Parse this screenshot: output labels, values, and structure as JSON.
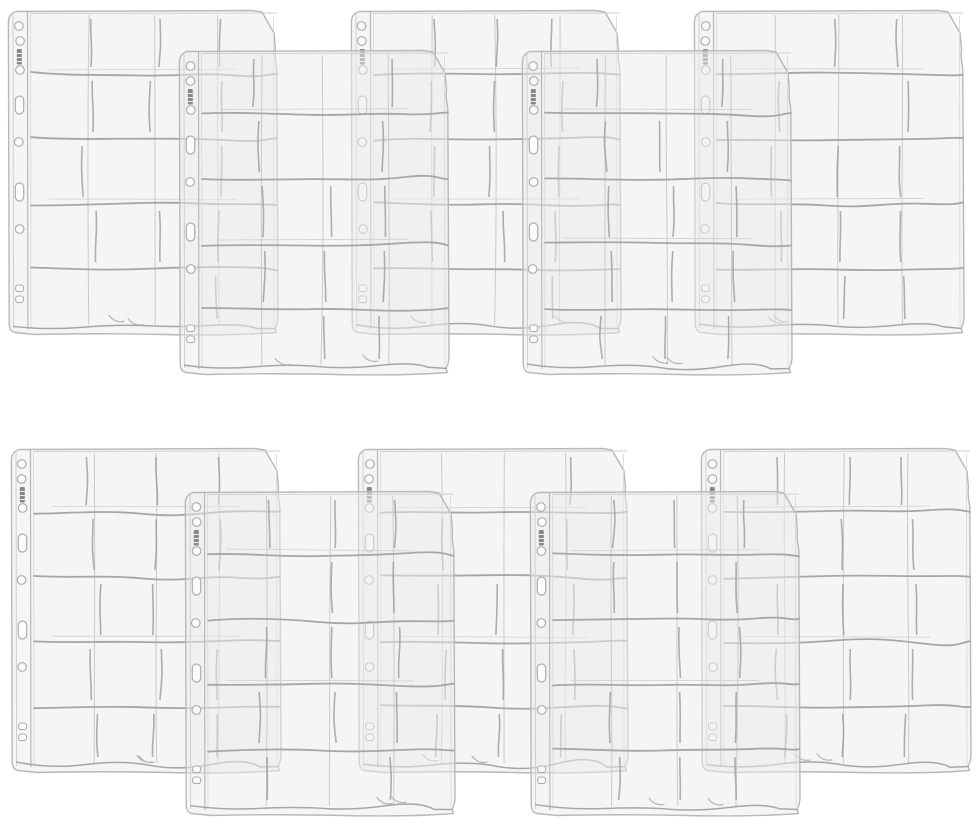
{
  "canvas": {
    "width": 980,
    "height": 828,
    "background": "#ffffff",
    "description": "Product photo: ten transparent plastic 20-pocket binder storage pages fanned out in two overlapping rows of five"
  },
  "product": {
    "item": "clear plastic pocket binder pages",
    "sheet_count": 10,
    "pockets_per_sheet": 20,
    "pocket_columns": 4,
    "pocket_rows": 5,
    "binder_edge": {
      "round_holes": 5,
      "oval_slots": 2,
      "micro_slots": 2,
      "brand_mark": "tiny vertical imprint (illegible)"
    }
  },
  "colors": {
    "background": "#ffffff",
    "sheet_fill": "#e9ebec",
    "sheet_fill_opacity": 0.52,
    "sheet_edge": "#b6b9bb",
    "inner_edge": "#d5d8da",
    "seam": "#a4a7a9",
    "seam_faint": "#cdd0d2",
    "pocket_divider": "#9da0a2",
    "column_line": "#c8cbcd",
    "hole_stroke": "#abaeb0",
    "hole_fill": "#fbfbfc",
    "brand_mark": "#85888a",
    "curl": "#b4b7b9"
  },
  "layout": {
    "sheet_width": 277,
    "sheet_height": 330,
    "grid_left": 26,
    "grid_right": 272,
    "row_seam_y": [
      66,
      131,
      196,
      261
    ],
    "grid_bottom_y": 318,
    "column_x": [
      85,
      148,
      211
    ],
    "hole_cy": [
      18,
      33,
      62,
      134,
      221
    ],
    "slot_cy": [
      97,
      184
    ],
    "micro_slot_y": [
      277,
      288
    ],
    "rows": [
      {
        "y_back": 8,
        "y_front": 48,
        "x_positions": [
          5,
          176,
          348,
          519,
          691
        ]
      },
      {
        "y_back": 446,
        "y_front": 489,
        "x_positions": [
          8,
          182,
          355,
          527,
          698
        ]
      }
    ],
    "layer_pattern": [
      "back",
      "front",
      "back",
      "front",
      "back"
    ]
  }
}
